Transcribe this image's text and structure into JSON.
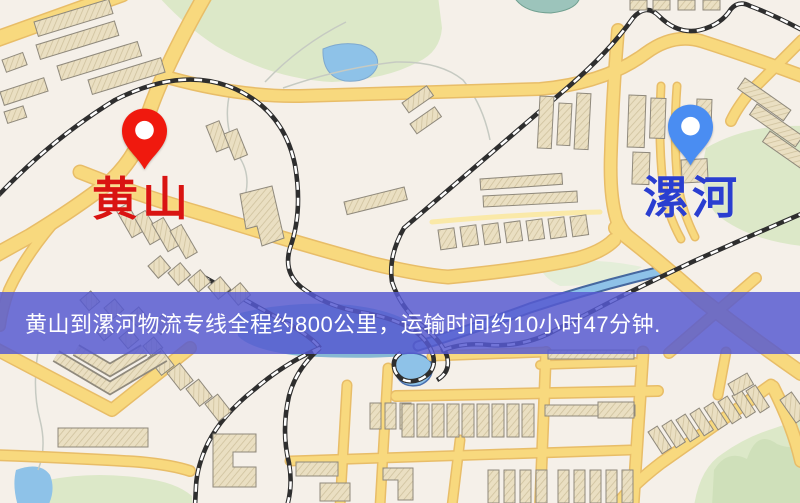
{
  "map": {
    "markers": [
      {
        "id": "origin",
        "label": "黄山",
        "pin_color": "#f0190e",
        "label_color": "#d91412",
        "pin_icon": "red-location-pin"
      },
      {
        "id": "destination",
        "label": "漯河",
        "pin_color": "#4a8df2",
        "label_color": "#2a3ed0",
        "pin_icon": "blue-location-pin"
      }
    ],
    "banner": {
      "text": "黄山到漯河物流专线全程约800公里，运输时间约10小时47分钟.",
      "background": "rgba(86,89,209,0.84)",
      "text_color": "#ffffff"
    },
    "colors": {
      "background": "#f5f0e9",
      "road": "#f8d97e",
      "road_casing": "#e8bd68",
      "road_minor": "#fae9a8",
      "building": "#eadfc2",
      "building_outline": "#8f897c",
      "park": "#dce8c8",
      "park_dark": "#cfe0ba",
      "water": "#8ec2e8",
      "water_deep": "#46689f",
      "railway": "#2e2e2e"
    }
  },
  "route": {
    "origin": "黄山",
    "destination": "漯河",
    "distance_text": "约800公里",
    "duration_text": "约10小时47分钟"
  }
}
